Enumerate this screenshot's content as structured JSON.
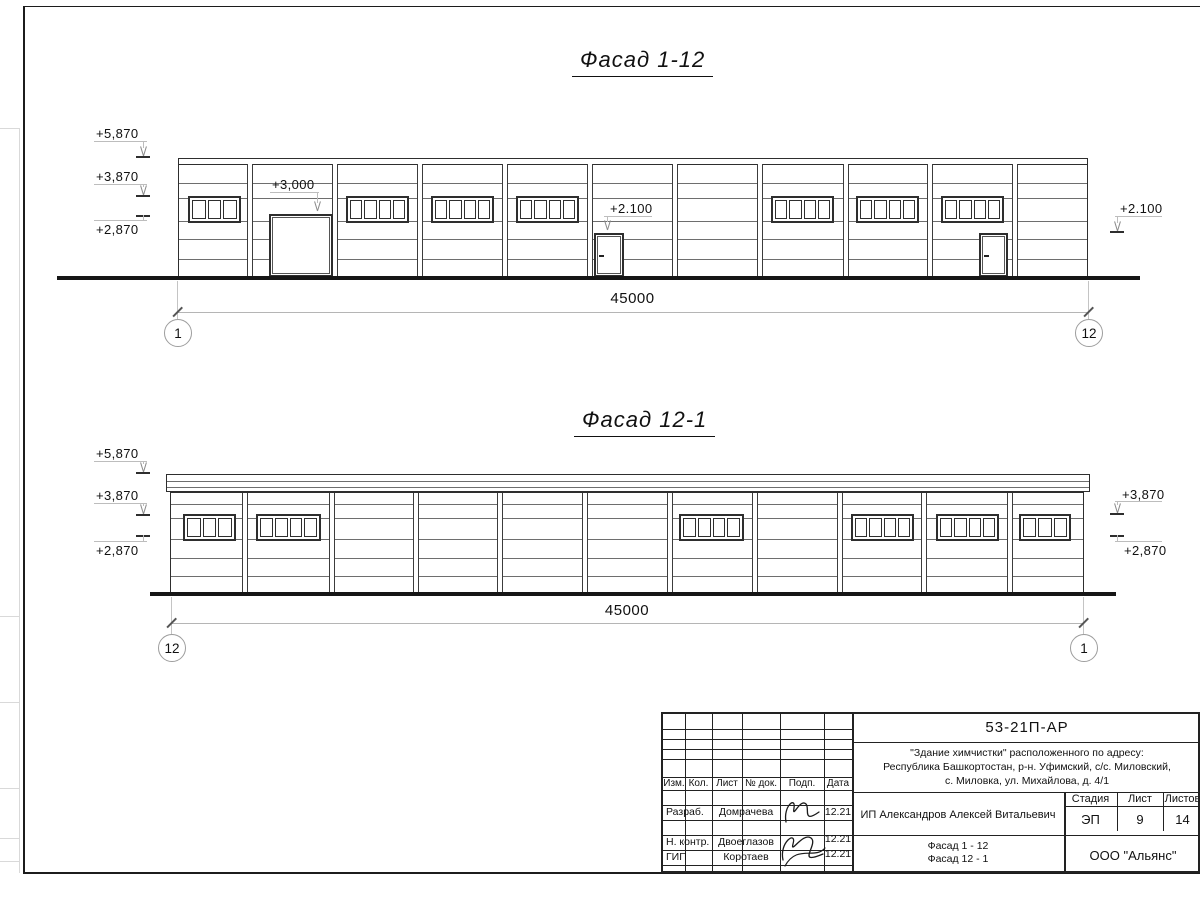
{
  "sheet": {
    "bg": "#ffffff",
    "frame_color": "#1c1c1c"
  },
  "facade1": {
    "title": "Фасад 1-12",
    "dimension": "45000",
    "axis_left": "1",
    "axis_right": "12",
    "geometry": {
      "title_pos": {
        "x": 572,
        "y": 47
      },
      "wall": {
        "l": 178,
        "t": 158,
        "r": 1088,
        "b": 277
      },
      "band_h": 5,
      "columns": [
        248,
        333,
        418,
        503,
        588,
        673,
        758,
        844,
        928,
        1013
      ],
      "hlines": [
        182,
        197,
        220,
        238,
        258
      ],
      "win_y": 195,
      "win_h": 27,
      "windows": [
        {
          "x": 187,
          "w": 53,
          "p": 3
        },
        {
          "x": 345,
          "w": 63,
          "p": 4
        },
        {
          "x": 430,
          "w": 63,
          "p": 4
        },
        {
          "x": 515,
          "w": 63,
          "p": 4
        },
        {
          "x": 770,
          "w": 63,
          "p": 4
        },
        {
          "x": 855,
          "w": 63,
          "p": 4
        },
        {
          "x": 940,
          "w": 63,
          "p": 4
        }
      ],
      "gate": {
        "x": 268,
        "w": 64,
        "y": 213
      },
      "doors": [
        {
          "x": 593,
          "w": 30
        },
        {
          "x": 978,
          "w": 29
        }
      ],
      "door_y": 232,
      "ground": {
        "x1": 57,
        "x2": 1140,
        "y": 276
      },
      "dim": {
        "x1": 177,
        "x2": 1088,
        "y": 312,
        "ty": 290,
        "ext_top": 281,
        "bub_y": 332
      },
      "marks": [
        {
          "label": "+5,870",
          "type": "down",
          "tx": 96,
          "ty": 126,
          "lx1": 94,
          "lx2": 147,
          "ly": 141,
          "ax": 143,
          "tip": 156,
          "tick": true
        },
        {
          "label": "+3,870",
          "type": "down",
          "tx": 96,
          "ty": 169,
          "lx1": 94,
          "lx2": 147,
          "ly": 184,
          "ax": 143,
          "tip": 195,
          "tick": true
        },
        {
          "label": "+2,870",
          "type": "up",
          "tx": 96,
          "ty": 222,
          "lx1": 94,
          "lx2": 147,
          "ly": 220,
          "ax": 143,
          "tick_y": 215
        },
        {
          "label": "+3,000",
          "type": "down",
          "tx": 272,
          "ty": 177,
          "lx1": 270,
          "lx2": 319,
          "ly": 192,
          "ax": 317,
          "tip": 211,
          "tick": false
        },
        {
          "label": "+2.100",
          "type": "down",
          "tx": 610,
          "ty": 201,
          "lx1": 604,
          "lx2": 652,
          "ly": 216,
          "ax": 607,
          "tip": 230,
          "tick": false
        },
        {
          "label": "+2.100",
          "type": "down",
          "tx": 1120,
          "ty": 201,
          "lx1": 1115,
          "lx2": 1162,
          "ly": 216,
          "ax": 1117,
          "tip": 231,
          "tick": true
        }
      ]
    }
  },
  "facade2": {
    "title": "Фасад 12-1",
    "dimension": "45000",
    "axis_left": "12",
    "axis_right": "1",
    "geometry": {
      "title_pos": {
        "x": 574,
        "y": 407
      },
      "wall": {
        "l": 170,
        "t": 492,
        "r": 1084,
        "b": 593
      },
      "parapet": {
        "l": 166,
        "t": 474,
        "r": 1090,
        "b": 492,
        "inner": [
          480,
          486
        ]
      },
      "columns": [
        243,
        330,
        414,
        498,
        583,
        668,
        753,
        838,
        922,
        1008
      ],
      "hlines": [
        503,
        517,
        538,
        557,
        575
      ],
      "win_y": 513,
      "win_h": 27,
      "windows": [
        {
          "x": 182,
          "w": 53,
          "p": 3
        },
        {
          "x": 255,
          "w": 65,
          "p": 4
        },
        {
          "x": 678,
          "w": 65,
          "p": 4
        },
        {
          "x": 850,
          "w": 63,
          "p": 4
        },
        {
          "x": 935,
          "w": 63,
          "p": 4
        },
        {
          "x": 1018,
          "w": 52,
          "p": 3
        }
      ],
      "doors": [],
      "ground": {
        "x1": 150,
        "x2": 1116,
        "y": 592
      },
      "dim": {
        "x1": 171,
        "x2": 1083,
        "y": 623,
        "ty": 602,
        "ext_top": 597,
        "bub_y": 647
      },
      "marks": [
        {
          "label": "+5,870",
          "type": "down",
          "tx": 96,
          "ty": 446,
          "lx1": 94,
          "lx2": 147,
          "ly": 461,
          "ax": 143,
          "tip": 472,
          "tick": true
        },
        {
          "label": "+3,870",
          "type": "down",
          "tx": 96,
          "ty": 488,
          "lx1": 94,
          "lx2": 147,
          "ly": 503,
          "ax": 143,
          "tip": 514,
          "tick": true
        },
        {
          "label": "+2,870",
          "type": "up",
          "tx": 96,
          "ty": 543,
          "lx1": 94,
          "lx2": 147,
          "ly": 541,
          "ax": 143,
          "tick_y": 535
        },
        {
          "label": "+3,870",
          "type": "down",
          "tx": 1122,
          "ty": 487,
          "lx1": 1115,
          "lx2": 1162,
          "ly": 501,
          "ax": 1117,
          "tip": 513,
          "tick": true
        },
        {
          "label": "+2,870",
          "type": "up",
          "tx": 1124,
          "ty": 543,
          "lx1": 1115,
          "lx2": 1162,
          "ly": 541,
          "ax": 1117,
          "tick_y": 535
        }
      ]
    }
  },
  "titleblock": {
    "doc_code": "53-21П-АР",
    "address_lines": [
      "\"Здание химчистки\" расположенного по адресу:",
      "Республика Башкортостан, р-н. Уфимский, с/с. Миловский,",
      "с. Миловка, ул. Михайлова, д. 4/1"
    ],
    "header_cells": [
      "Изм.",
      "Кол.",
      "Лист",
      "№ док.",
      "Подп.",
      "Дата"
    ],
    "rows": [
      {
        "role": "Разраб.",
        "name": "Домрачева",
        "date": "12.21"
      },
      {
        "role": "Н. контр.",
        "name": "Двоеглазов",
        "date": "12.21"
      },
      {
        "role": "ГИП",
        "name": "Коротаев",
        "date": "12.21"
      }
    ],
    "client": "ИП Александров Алексей Витальевич",
    "stage_label": "Стадия",
    "sheet_label": "Лист",
    "sheets_label": "Листов",
    "stage": "ЭП",
    "sheet_no": "9",
    "sheets_total": "14",
    "drawing_names": [
      "Фасад 1 - 12",
      "Фасад 12 - 1"
    ],
    "company": "ООО \"Альянс\""
  }
}
